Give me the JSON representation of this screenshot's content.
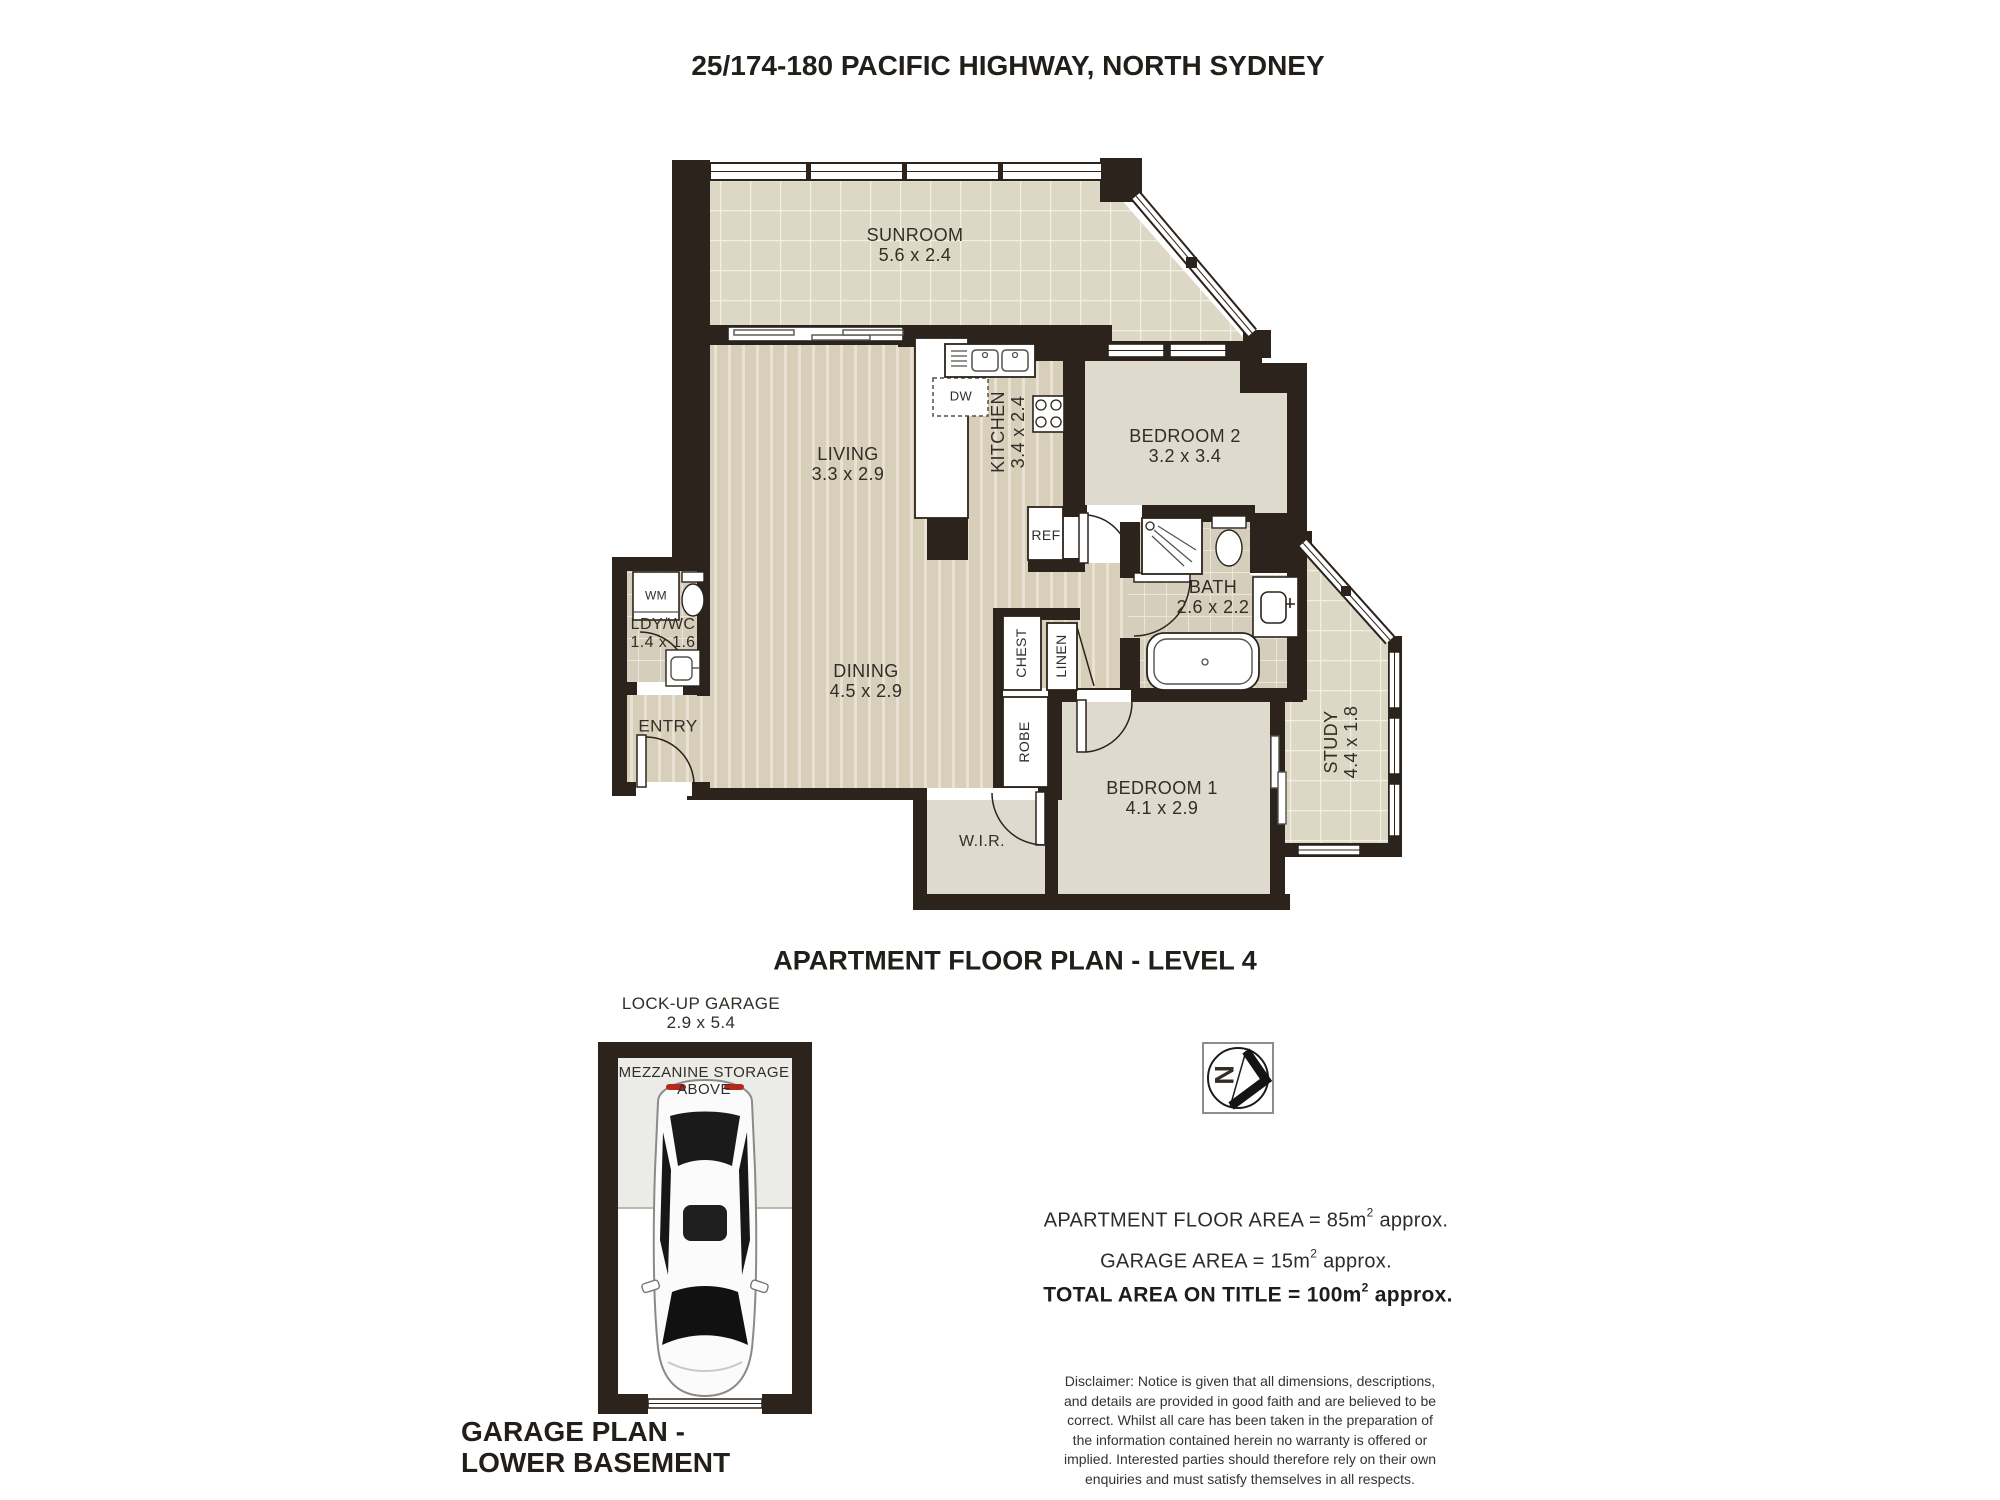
{
  "header": {
    "title": "25/174-180 PACIFIC HIGHWAY, NORTH SYDNEY"
  },
  "captions": {
    "apartment_plan": "APARTMENT FLOOR PLAN - LEVEL 4",
    "garage_line1": "GARAGE PLAN -",
    "garage_line2": "LOWER BASEMENT"
  },
  "rooms": {
    "sunroom": {
      "name": "SUNROOM",
      "dims": "5.6 x 2.4"
    },
    "living": {
      "name": "LIVING",
      "dims": "3.3 x 2.9"
    },
    "kitchen": {
      "name": "KITCHEN",
      "dims": "3.4 x 2.4"
    },
    "bedroom2": {
      "name": "BEDROOM 2",
      "dims": "3.2 x 3.4"
    },
    "bath": {
      "name": "BATH",
      "dims": "2.6 x 2.2"
    },
    "dining": {
      "name": "DINING",
      "dims": "4.5 x 2.9"
    },
    "ldy_wc": {
      "name": "LDY/WC",
      "dims": "1.4 x 1.6"
    },
    "entry": {
      "name": "ENTRY"
    },
    "bedroom1": {
      "name": "BEDROOM 1",
      "dims": "4.1 x 2.9"
    },
    "wir": {
      "name": "W.I.R."
    },
    "study": {
      "name": "STUDY",
      "dims": "4.4 x 1.8"
    }
  },
  "closets": {
    "chest": "CHEST",
    "linen": "LINEN",
    "robe": "ROBE"
  },
  "appliances": {
    "dw": "DW",
    "ref": "REF",
    "wm": "WM"
  },
  "garage": {
    "label": "LOCK-UP GARAGE",
    "dims": "2.9 x 5.4",
    "storage_line1": "MEZZANINE STORAGE",
    "storage_line2": "ABOVE"
  },
  "compass": {
    "letter": "N"
  },
  "areas": {
    "apartment": {
      "pre": "APARTMENT FLOOR AREA = 85m",
      "sup": "2",
      "post": " approx."
    },
    "garage": {
      "pre": "GARAGE AREA = 15m",
      "sup": "2",
      "post": " approx."
    },
    "total": {
      "pre": "TOTAL AREA ON TITLE  = 100m",
      "sup": "2",
      "post": " approx."
    }
  },
  "disclaimer": {
    "lines": [
      "Disclaimer: Notice is given that all dimensions, descriptions,",
      "and details are provided in good faith and are believed to be",
      "correct. Whilst all care has been taken in the preparation of",
      "the information contained herein no warranty is offered or",
      "implied. Interested parties should therefore rely on their own",
      "enquiries and must satisfy themselves in all respects."
    ]
  },
  "colors": {
    "wall": "#2b231c",
    "timber_floor": "#d8cfbb",
    "tile_floor": "#ddd8c5",
    "carpet_floor": "#dedacd",
    "bath_tile": "#d6cebc",
    "tail_light_red": "#b5281e"
  }
}
